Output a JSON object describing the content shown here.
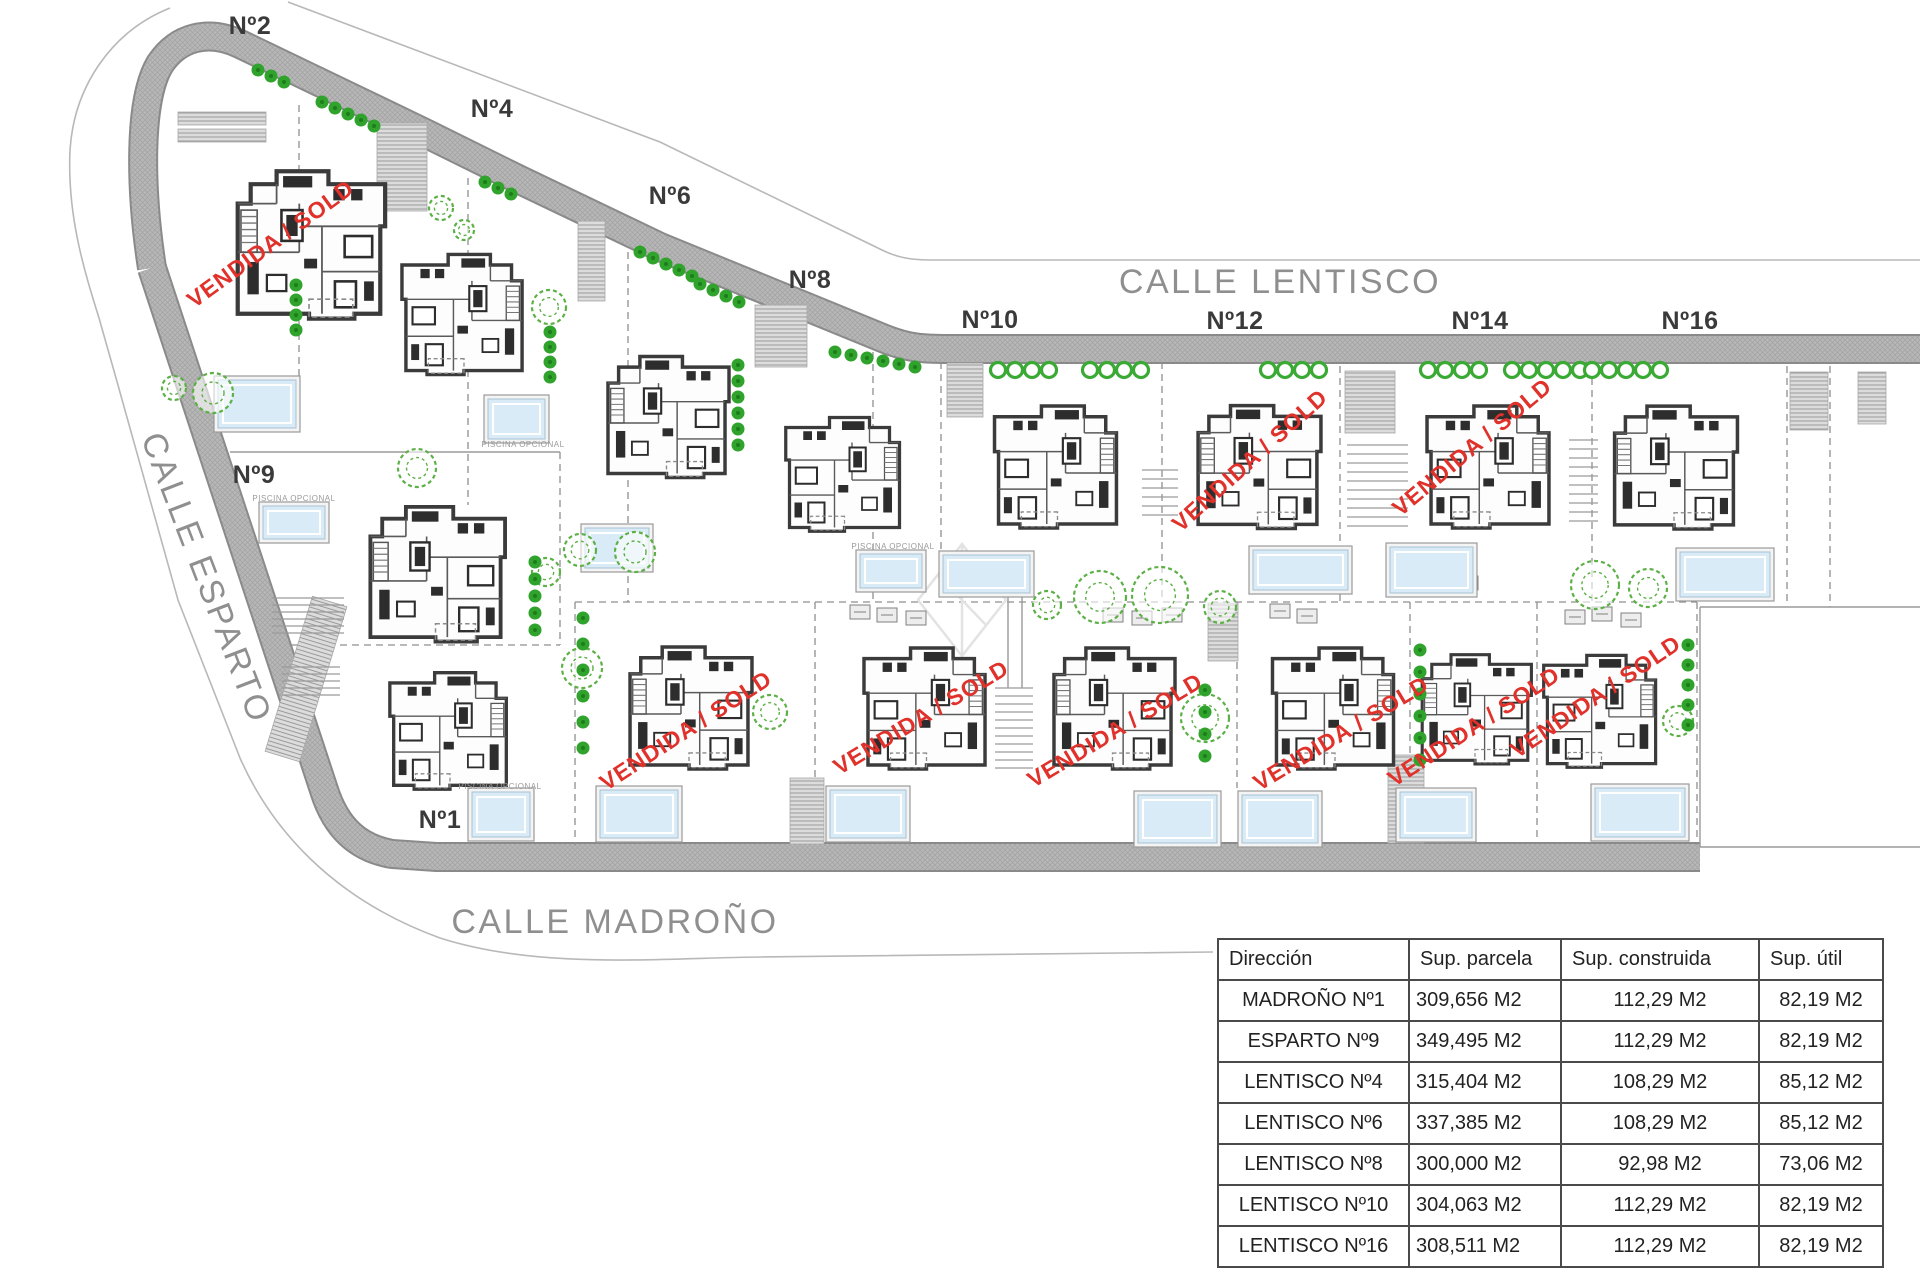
{
  "document": {
    "kind": "residential development site plan"
  },
  "colors": {
    "sold": "#e0312b",
    "road": "#b7b7b7",
    "road_edge": "#8a8a8a",
    "tree": "#5cb045",
    "bush": "#2fa32b",
    "ring_bush": "#3aaa35",
    "pool_water": "#d8ebf6",
    "pool_frame": "#999999",
    "wall": "#3b3b3b",
    "street_text": "#8f8f8f",
    "plot_text": "#3a3a3a",
    "boundary": "#8f8f8f",
    "table_border": "#4a4a4a",
    "table_text": "#222222"
  },
  "plan": {
    "streets": [
      {
        "id": "calle-lentisco",
        "label": "CALLE LENTISCO",
        "x": 1280,
        "y": 293,
        "rotate": 0
      },
      {
        "id": "calle-esparto",
        "label": "CALLE ESPARTO",
        "x": 196,
        "y": 582,
        "rotate": 69
      },
      {
        "id": "calle-madrono",
        "label": "CALLE MADROÑO",
        "x": 615,
        "y": 933,
        "rotate": 0
      }
    ],
    "plots": [
      {
        "label": "Nº2",
        "x": 250,
        "y": 34
      },
      {
        "label": "Nº4",
        "x": 492,
        "y": 117
      },
      {
        "label": "Nº6",
        "x": 670,
        "y": 204
      },
      {
        "label": "Nº8",
        "x": 810,
        "y": 288
      },
      {
        "label": "Nº10",
        "x": 990,
        "y": 328
      },
      {
        "label": "Nº12",
        "x": 1235,
        "y": 329
      },
      {
        "label": "Nº14",
        "x": 1480,
        "y": 329
      },
      {
        "label": "Nº16",
        "x": 1690,
        "y": 329
      },
      {
        "label": "Nº9",
        "x": 254,
        "y": 483
      },
      {
        "label": "Nº1",
        "x": 440,
        "y": 828
      }
    ],
    "sold_label": "VENDIDA / SOLD",
    "sold": [
      {
        "x": 275,
        "y": 250,
        "angle": -36
      },
      {
        "x": 1255,
        "y": 466,
        "angle": -42
      },
      {
        "x": 1477,
        "y": 453,
        "angle": -40
      },
      {
        "x": 690,
        "y": 737,
        "angle": -33
      },
      {
        "x": 925,
        "y": 724,
        "angle": -31
      },
      {
        "x": 1119,
        "y": 737,
        "angle": -31
      },
      {
        "x": 1345,
        "y": 740,
        "angle": -31
      },
      {
        "x": 1478,
        "y": 733,
        "angle": -33
      },
      {
        "x": 1600,
        "y": 703,
        "angle": -34
      }
    ],
    "houses": [
      {
        "id": "house-n2",
        "x": 228,
        "y": 150,
        "w": 162,
        "h": 185,
        "flip": false
      },
      {
        "id": "house-n4",
        "x": 398,
        "y": 222,
        "w": 132,
        "h": 181,
        "flip": true
      },
      {
        "id": "house-n6",
        "x": 600,
        "y": 325,
        "w": 133,
        "h": 180,
        "flip": false
      },
      {
        "id": "house-n8",
        "x": 782,
        "y": 385,
        "w": 125,
        "h": 175,
        "flip": true
      },
      {
        "id": "house-n9",
        "x": 348,
        "y": 498,
        "w": 175,
        "h": 148,
        "flip": false
      },
      {
        "id": "house-n10",
        "x": 975,
        "y": 398,
        "w": 165,
        "h": 134,
        "flip": true
      },
      {
        "id": "house-n12",
        "x": 1190,
        "y": 397,
        "w": 135,
        "h": 136,
        "flip": false
      },
      {
        "id": "house-n14",
        "x": 1415,
        "y": 398,
        "w": 150,
        "h": 134,
        "flip": true
      },
      {
        "id": "house-n16",
        "x": 1600,
        "y": 398,
        "w": 148,
        "h": 135,
        "flip": false
      },
      {
        "id": "house-n1",
        "x": 367,
        "y": 665,
        "w": 166,
        "h": 128,
        "flip": true
      },
      {
        "id": "house-b1",
        "x": 620,
        "y": 639,
        "w": 138,
        "h": 134,
        "flip": false
      },
      {
        "id": "house-b2",
        "x": 853,
        "y": 640,
        "w": 147,
        "h": 133,
        "flip": true
      },
      {
        "id": "house-b3",
        "x": 1035,
        "y": 640,
        "w": 155,
        "h": 133,
        "flip": false
      },
      {
        "id": "house-b4",
        "x": 1260,
        "y": 640,
        "w": 150,
        "h": 133,
        "flip": true
      },
      {
        "id": "house-b5",
        "x": 1415,
        "y": 641,
        "w": 120,
        "h": 133,
        "flip": false
      },
      {
        "id": "house-b6",
        "x": 1540,
        "y": 642,
        "w": 123,
        "h": 135,
        "flip": true
      }
    ],
    "pools": [
      {
        "x": 218,
        "y": 380,
        "w": 78,
        "h": 48
      },
      {
        "x": 488,
        "y": 399,
        "w": 57,
        "h": 40
      },
      {
        "x": 585,
        "y": 528,
        "w": 64,
        "h": 40
      },
      {
        "x": 860,
        "y": 554,
        "w": 62,
        "h": 34
      },
      {
        "x": 263,
        "y": 506,
        "w": 62,
        "h": 33
      },
      {
        "x": 943,
        "y": 555,
        "w": 87,
        "h": 38
      },
      {
        "x": 1253,
        "y": 550,
        "w": 95,
        "h": 40
      },
      {
        "x": 1390,
        "y": 547,
        "w": 83,
        "h": 46
      },
      {
        "x": 1680,
        "y": 552,
        "w": 90,
        "h": 45
      },
      {
        "x": 472,
        "y": 792,
        "w": 58,
        "h": 45
      },
      {
        "x": 600,
        "y": 790,
        "w": 78,
        "h": 48
      },
      {
        "x": 830,
        "y": 790,
        "w": 76,
        "h": 48
      },
      {
        "x": 1138,
        "y": 795,
        "w": 79,
        "h": 48
      },
      {
        "x": 1242,
        "y": 795,
        "w": 76,
        "h": 48
      },
      {
        "x": 1400,
        "y": 792,
        "w": 72,
        "h": 46
      },
      {
        "x": 1595,
        "y": 788,
        "w": 90,
        "h": 49
      }
    ],
    "pool_label": "PISCINA OPCIONAL",
    "pool_labels_at": [
      {
        "x": 294,
        "y": 501
      },
      {
        "x": 523,
        "y": 447
      },
      {
        "x": 500,
        "y": 789
      },
      {
        "x": 893,
        "y": 549
      }
    ],
    "trees": [
      [
        213,
        393,
        20
      ],
      [
        174,
        388,
        12
      ],
      [
        441,
        208,
        12
      ],
      [
        464,
        230,
        10
      ],
      [
        549,
        307,
        17
      ],
      [
        417,
        468,
        19
      ],
      [
        546,
        572,
        14
      ],
      [
        580,
        550,
        16
      ],
      [
        635,
        552,
        20
      ],
      [
        1047,
        605,
        14
      ],
      [
        1100,
        597,
        26
      ],
      [
        1160,
        595,
        28
      ],
      [
        1220,
        607,
        16
      ],
      [
        1205,
        718,
        24
      ],
      [
        1595,
        585,
        24
      ],
      [
        1648,
        588,
        19
      ],
      [
        582,
        668,
        20
      ],
      [
        770,
        712,
        17
      ],
      [
        1678,
        721,
        15
      ]
    ],
    "bush_rows": [
      {
        "x": 258,
        "y": 70,
        "n": 3,
        "dx": 13,
        "dy": 6
      },
      {
        "x": 322,
        "y": 102,
        "n": 5,
        "dx": 13,
        "dy": 6
      },
      {
        "x": 485,
        "y": 182,
        "n": 3,
        "dx": 13,
        "dy": 6
      },
      {
        "x": 640,
        "y": 252,
        "n": 5,
        "dx": 13,
        "dy": 6
      },
      {
        "x": 700,
        "y": 284,
        "n": 4,
        "dx": 13,
        "dy": 6
      },
      {
        "x": 835,
        "y": 352,
        "n": 6,
        "dx": 16,
        "dy": 3
      }
    ],
    "bush_cols": [
      {
        "x": 296,
        "y": 285,
        "n": 4,
        "dy": 15
      },
      {
        "x": 738,
        "y": 365,
        "n": 6,
        "dy": 16
      },
      {
        "x": 550,
        "y": 332,
        "n": 4,
        "dy": 15
      },
      {
        "x": 535,
        "y": 562,
        "n": 5,
        "dy": 17
      },
      {
        "x": 583,
        "y": 618,
        "n": 6,
        "dy": 26
      },
      {
        "x": 1205,
        "y": 690,
        "n": 4,
        "dy": 22
      },
      {
        "x": 1420,
        "y": 650,
        "n": 6,
        "dy": 22
      },
      {
        "x": 1688,
        "y": 645,
        "n": 5,
        "dy": 20
      }
    ],
    "ring_rows": [
      {
        "x": 998,
        "y": 370,
        "n": 4,
        "dx": 17
      },
      {
        "x": 1090,
        "y": 370,
        "n": 4,
        "dx": 17
      },
      {
        "x": 1268,
        "y": 370,
        "n": 4,
        "dx": 17
      },
      {
        "x": 1428,
        "y": 370,
        "n": 4,
        "dx": 17
      },
      {
        "x": 1512,
        "y": 370,
        "n": 5,
        "dx": 17
      },
      {
        "x": 1592,
        "y": 370,
        "n": 5,
        "dx": 17
      }
    ],
    "driveways": [
      [
        178,
        112,
        88,
        13,
        0
      ],
      [
        178,
        129,
        88,
        13,
        0
      ],
      [
        377,
        123,
        50,
        88,
        0
      ],
      [
        578,
        221,
        27,
        80,
        0
      ],
      [
        755,
        305,
        52,
        62,
        0
      ],
      [
        947,
        363,
        36,
        54,
        0
      ],
      [
        1345,
        371,
        50,
        62,
        0
      ],
      [
        1790,
        372,
        38,
        58,
        0
      ],
      [
        1858,
        372,
        28,
        52,
        0
      ],
      [
        790,
        778,
        34,
        66,
        0
      ],
      [
        1388,
        755,
        36,
        88,
        0
      ],
      [
        1208,
        603,
        30,
        58,
        0
      ],
      [
        288,
        598,
        36,
        162,
        17
      ]
    ],
    "terraces": [
      [
        850,
        605
      ],
      [
        877,
        608
      ],
      [
        906,
        611
      ],
      [
        1103,
        608
      ],
      [
        1132,
        611
      ],
      [
        1162,
        608
      ],
      [
        1270,
        604
      ],
      [
        1297,
        609
      ],
      [
        1565,
        610
      ],
      [
        1592,
        607
      ],
      [
        1621,
        613
      ],
      [
        1430,
        572
      ],
      [
        1458,
        576
      ]
    ],
    "ramps": [
      {
        "x1": 1142,
        "x2": 1178,
        "y": 470,
        "n": 6,
        "dy": 9
      },
      {
        "x1": 1347,
        "x2": 1408,
        "y": 445,
        "n": 10,
        "dy": 9
      },
      {
        "x1": 1569,
        "x2": 1598,
        "y": 440,
        "n": 10,
        "dy": 9
      },
      {
        "x1": 272,
        "x2": 344,
        "y": 598,
        "n": 6,
        "dy": 7
      },
      {
        "x1": 282,
        "x2": 340,
        "y": 667,
        "n": 5,
        "dy": 7
      },
      {
        "x1": 995,
        "x2": 1033,
        "y": 688,
        "n": 11,
        "dy": 8
      }
    ],
    "boundaries": {
      "dashed": [
        [
          299,
          105,
          299,
          427
        ],
        [
          468,
          178,
          468,
          505
        ],
        [
          628,
          252,
          628,
          602
        ],
        [
          873,
          352,
          873,
          602
        ],
        [
          941,
          362,
          941,
          602
        ],
        [
          1162,
          362,
          1162,
          602
        ],
        [
          1340,
          366,
          1340,
          602
        ],
        [
          1592,
          366,
          1592,
          602
        ],
        [
          1787,
          366,
          1787,
          602
        ],
        [
          1830,
          366,
          1830,
          607
        ],
        [
          575,
          602,
          575,
          845
        ],
        [
          815,
          602,
          815,
          843
        ],
        [
          1237,
          602,
          1237,
          788
        ],
        [
          1410,
          602,
          1410,
          843
        ],
        [
          1537,
          602,
          1537,
          843
        ],
        [
          1697,
          602,
          1697,
          845
        ],
        [
          575,
          602,
          1697,
          602
        ],
        [
          560,
          452,
          560,
          645
        ],
        [
          292,
          645,
          560,
          645
        ]
      ],
      "solid": [
        [
          230,
          452,
          560,
          452
        ],
        [
          1700,
          607,
          1920,
          607
        ],
        [
          1700,
          607,
          1700,
          847
        ],
        [
          1700,
          847,
          1920,
          847
        ],
        [
          1008,
          560,
          1008,
          688
        ],
        [
          1022,
          560,
          1022,
          688
        ]
      ]
    },
    "watermark": {
      "x": 962,
      "y": 600,
      "rx": 44,
      "ry": 56
    }
  },
  "table": {
    "x": 1217,
    "y": 938,
    "col_w": [
      191,
      152,
      198,
      124
    ],
    "headers": [
      "Dirección",
      "Sup. parcela",
      "Sup. construida",
      "Sup. útil"
    ],
    "rows": [
      [
        "MADROÑO Nº1",
        "309,656 M2",
        "112,29 M2",
        "82,19 M2"
      ],
      [
        "ESPARTO Nº9",
        "349,495 M2",
        "112,29 M2",
        "82,19 M2"
      ],
      [
        "LENTISCO Nº4",
        "315,404 M2",
        "108,29 M2",
        "85,12 M2"
      ],
      [
        "LENTISCO Nº6",
        "337,385 M2",
        "108,29 M2",
        "85,12 M2"
      ],
      [
        "LENTISCO Nº8",
        "300,000 M2",
        "92,98 M2",
        "73,06 M2"
      ],
      [
        "LENTISCO Nº10",
        "304,063 M2",
        "112,29 M2",
        "82,19 M2"
      ],
      [
        "LENTISCO Nº16",
        "308,511 M2",
        "112,29 M2",
        "82,19 M2"
      ]
    ]
  }
}
